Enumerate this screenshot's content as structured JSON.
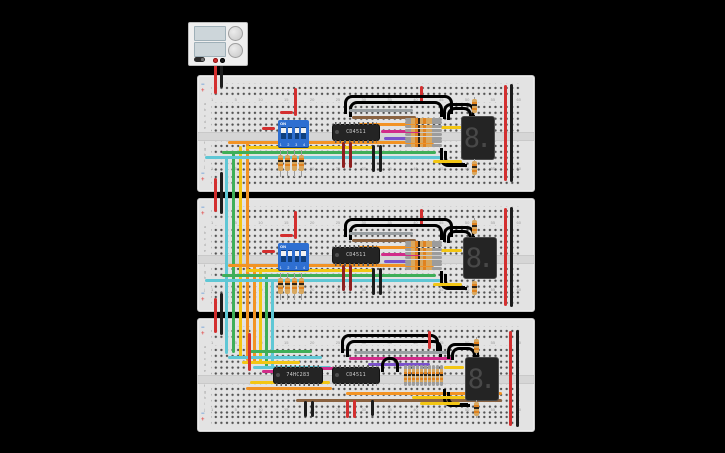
{
  "palette": {
    "wire-red": "#d32f2f",
    "wire-black": "#1c1c1c",
    "wire-cyan": "#5fc7d5",
    "wire-green": "#3fae58",
    "wire-yellow": "#f3c614",
    "wire-orange": "#f29324",
    "wire-gray": "#9aa0a3",
    "wire-brown": "#8a6240",
    "wire-magenta": "#d12d8a",
    "wire-purple": "#7b52cc",
    "wire-blue": "#2b7de0",
    "wire-darkred": "#8e2020",
    "dip-blue": "#2e6fd1",
    "board-bg": "#e3e3e3",
    "background": "#000000"
  },
  "power_supply": {
    "screen_top": "",
    "screen_bottom": "",
    "terminal_positive": "red",
    "terminal_negative": "black"
  },
  "breadboard": {
    "rail_minus": "−",
    "rail_plus": "+",
    "columns": [
      "1",
      "5",
      "10",
      "15",
      "20",
      "25",
      "30",
      "35",
      "40",
      "45",
      "50",
      "55",
      "60"
    ],
    "rows_top": [
      "a",
      "b",
      "c",
      "d",
      "e"
    ],
    "rows_bottom": [
      "f",
      "g",
      "h",
      "i",
      "j"
    ]
  },
  "boards": [
    {
      "dip": {
        "on_label": "ON",
        "positions_label": "1 2 3 4"
      },
      "ics": [
        {
          "label": "CD4511"
        }
      ],
      "display": {
        "value": "8."
      }
    },
    {
      "dip": {
        "on_label": "ON",
        "positions_label": "1 2 3 4"
      },
      "ics": [
        {
          "label": "CD4511"
        }
      ],
      "display": {
        "value": "8."
      }
    },
    {
      "ics": [
        {
          "label": "74HC283"
        },
        {
          "label": "CD4511"
        }
      ],
      "display": {
        "value": "8."
      }
    }
  ]
}
